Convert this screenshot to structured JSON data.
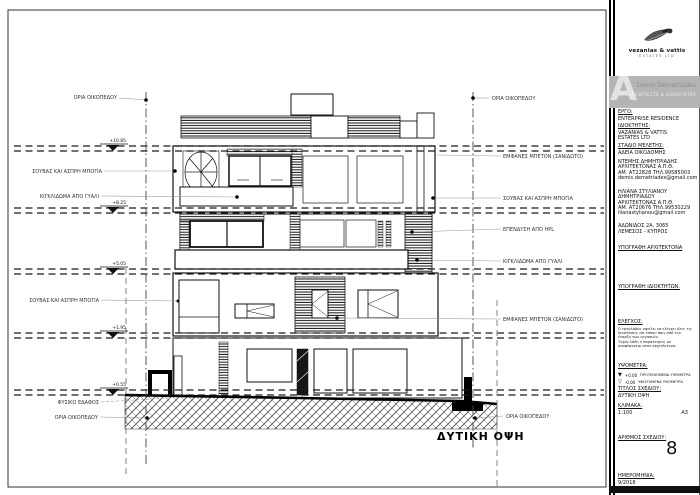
{
  "sheet": {
    "drawing_title": "ΔΥΤΙΚΗ ΟΨΗ",
    "labels_left": [
      "ΟΡΙΑ ΟΙΚΟΠΕΔΟΥ",
      "ΣΟΥΒΑΣ ΚΑΙ ΑΣΠΡΗ ΜΠΟΓΙΑ",
      "ΚΙΓΚΛΙΔΩΜΑ ΑΠΟ ΓΥΑΛΙ",
      "ΣΟΥΒΑΣ ΚΑΙ ΑΣΠΡΗ ΜΠΟΓΙΑ",
      "ΦΥΣΙΚΟ ΕΔΑΦΟΣ",
      "ΟΡΙΑ ΟΙΚΟΠΕΔΟΥ"
    ],
    "labels_right": [
      "ΟΡΙΑ ΟΙΚΟΠΕΔΟΥ",
      "ΕΜΦΑΝΕΣ ΜΠΕΤΟΝ (ΣΑΝΙΔΩΤΟ)",
      "ΣΟΥΒΑΣ ΚΑΙ ΑΣΠΡΗ ΜΠΟΓΙΑ",
      "ΕΠΕΝΔΥΣΗ ΑΠΟ HPL",
      "ΚΙΓΚΛΙΔΩΜΑ ΑΠΟ ΓΥΑΛΙ",
      "ΕΜΦΑΝΕΣ ΜΠΕΤΟΝ (ΣΑΝΙΔΩΤΟ)",
      "ΟΡΙΑ ΟΙΚΟΠΕΔΟΥ"
    ],
    "elevation_markers": [
      "+10.85",
      "+8.25",
      "+5.05",
      "+1.95",
      "+0.55"
    ]
  },
  "title_block": {
    "logo_company": "vezanias & vattis",
    "logo_sub": "ESTATES LTD",
    "brand_letter": "A",
    "brand_name": "Demis Demetriades",
    "brand_sub": "ARCHITECTS & ASSOCIATES",
    "project_label": "ΕΡΓΟ:",
    "project_value": "ENTERPRISE RESIDENCE",
    "owner_label": "ΙΔΙΟΚΤΗΤΗΣ:",
    "owner_value1": "VAZANIAS & VATTIS",
    "owner_value2": "ESTATES LTD",
    "stage_label": "ΣΤΑΔΙΟ ΜΕΛΕΤΗΣ:",
    "stage_value": "ΑΔΕΙΑ ΟΙΚΟΔΟΜΗΣ",
    "architect1": {
      "name": "ΝΤΕΜΗΣ ΔΗΜΗΤΡΙΑΔΗΣ",
      "title": "ΑΡΧΙΤΕΚΤΟΝΑΣ Α.Π.Θ.",
      "reg": "ΑΜ. ΑΤ22828 ΤΗΛ.99585003",
      "email": "demis.demetriades@gmail.com"
    },
    "architect2": {
      "name": "ΗΛΙΑΝΑ ΣΤΥΛΙΑΝΟΥ",
      "name2": "ΔΗΜΗΤΡΙΑΔΟΥ",
      "title": "ΑΡΧΙΤΕΚΤΟΝΑΣ Α.Π.Θ.",
      "reg": "ΑΜ. ΑΤ20676 ΤΗΛ.99530229",
      "email": "ilianastylianou@gmail.com"
    },
    "address_line1": "ΑΔΩΝΙΔΟΣ 2Α, 3065",
    "address_line2": "ΛΕΜΕΣΟΣ - ΚΥΠΡΟΣ",
    "sign_architect": "ΥΠΟΓΡΑΦΗ ΑΡΧΙΤΕΚΤΟΝΑ",
    "sign_owner": "ΥΠΟΓΡΑΦΗ ΙΔΙΟΚΤΗΤΩΝ.",
    "check_label": "ΕΛΕΓΧΟΣ:",
    "check_lines": [
      "Ο εργολάβος οφείλει να ελέγχει όλες τις",
      "διαστάσεις επί τόπου πριν από την",
      "έναρξη των εργασιών.",
      "Τυχόν λάθη ή παραλείψεις να",
      "αναφέρονται στον αρχιτέκτονα."
    ],
    "levels_label": "ΥΨΟΜΕΤΡΑ:",
    "level_rows": [
      {
        "symbol": "▼",
        "value": "+0.00",
        "text": "ΠΡΟΤΕΙΝΟΜΕΝΑ ΥΨΟΜΕΤΡΑ"
      },
      {
        "symbol": "▽",
        "value": "-0.00",
        "text": "ΥΦΙΣΤΑΜΕΝΑ ΥΨΟΜΕΤΡΑ"
      }
    ],
    "drawing_title_label": "ΤΙΤΛΟΣ ΣΧΕΔΙΟΥ:",
    "drawing_title_value": "ΔΥΤΙΚΗ ΟΨΗ",
    "scale_label": "ΚΛΙΜΑΚΑ:",
    "scale_value": "1:100",
    "paper_size": "A3",
    "number_label": "ΑΡΙΘΜΟΣ ΣΧΕΔΙΟΥ:",
    "number_value": "8",
    "date_label": "ΗΜΕΡΟΜΗΝΙΑ:",
    "date_value": "9/2018"
  }
}
